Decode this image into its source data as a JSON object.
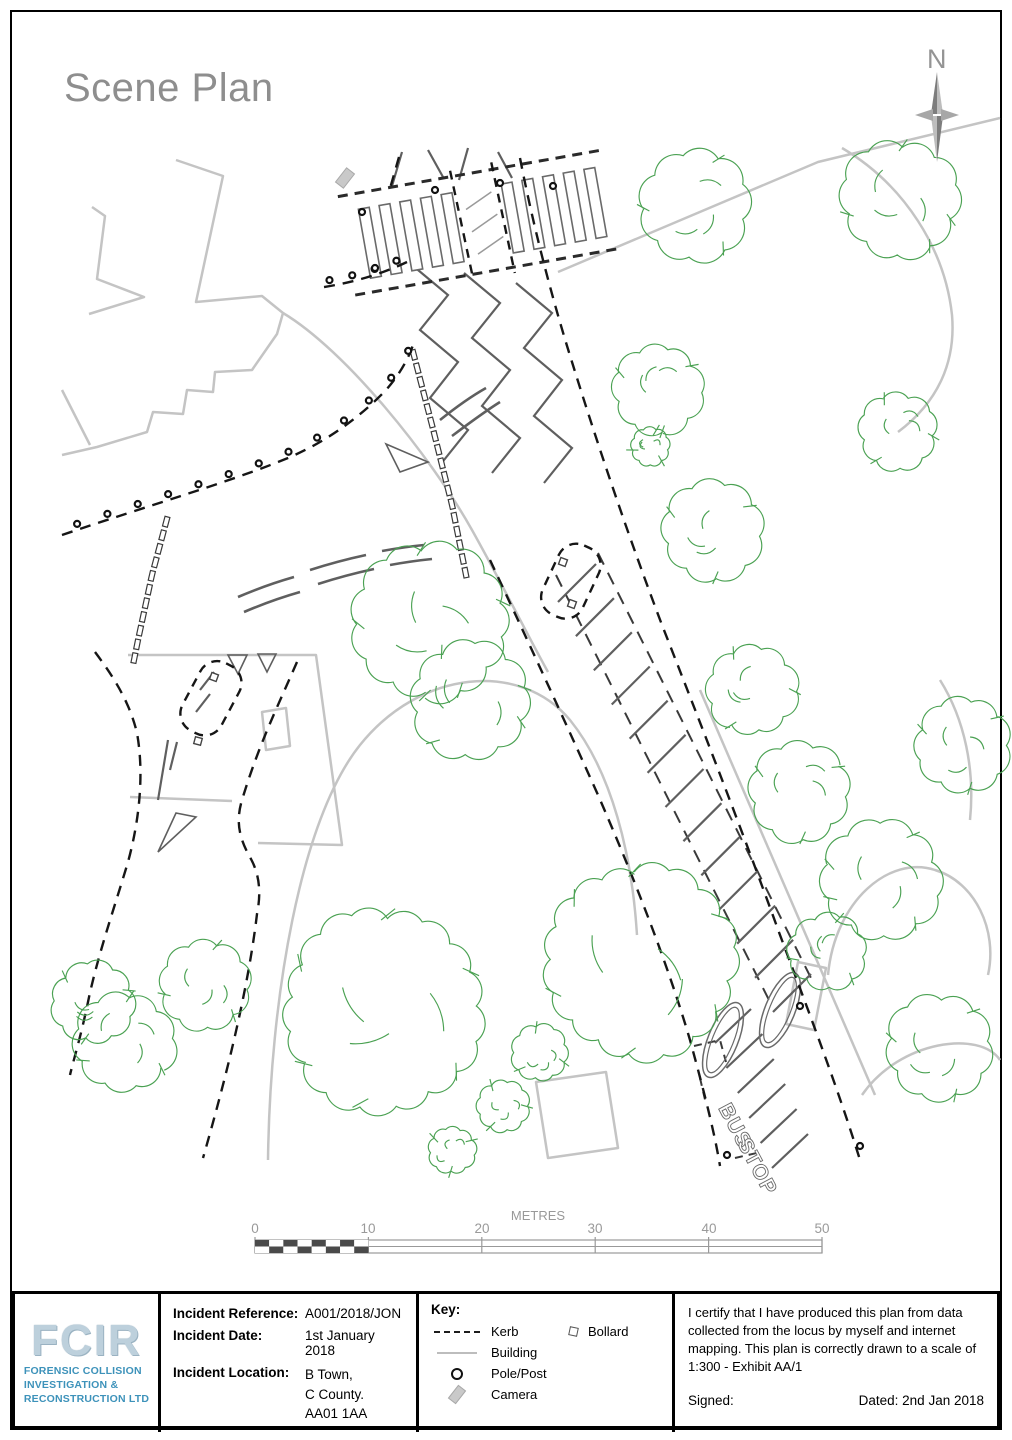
{
  "page": {
    "title": "Scene Plan"
  },
  "north_arrow": {
    "label": "N"
  },
  "map": {
    "bus_stop_word1": "BUS",
    "bus_stop_word2": "STOP"
  },
  "scale_bar": {
    "unit_label": "METRES",
    "ticks": [
      "0",
      "10",
      "20",
      "30",
      "40",
      "50"
    ]
  },
  "footer": {
    "logo": {
      "acronym": "FCIR",
      "lines": [
        "FORENSIC COLLISION",
        "INVESTIGATION &",
        "RECONSTRUCTION LTD"
      ],
      "accent_color": "#3d92ba"
    },
    "incident": {
      "reference_label": "Incident Reference:",
      "reference_value": "A001/2018/JON",
      "date_label": "Incident Date:",
      "date_value": "1st January 2018",
      "location_label": "Incident Location:",
      "location_lines": [
        "B Town,",
        "C County.",
        "AA01 1AA"
      ]
    },
    "key": {
      "title": "Key:",
      "items": [
        {
          "label": "Kerb"
        },
        {
          "label": "Building"
        },
        {
          "label": "Pole/Post"
        },
        {
          "label": "Camera"
        },
        {
          "label": "Bollard"
        }
      ]
    },
    "certification": {
      "text": "I certify that I have produced this plan from data collected from the locus by myself and internet mapping. This plan is correctly drawn to a scale of 1:300 - Exhibit AA/1",
      "signed_label": "Signed:",
      "dated_label": "Dated: 2nd Jan 2018"
    }
  },
  "colors": {
    "kerb": "#161616",
    "building": "#c4c4c4",
    "tree": "#4aa152",
    "road_marking": "#5f5f5f",
    "title_gray": "#8e8e8e",
    "scale_gray": "#999999"
  }
}
